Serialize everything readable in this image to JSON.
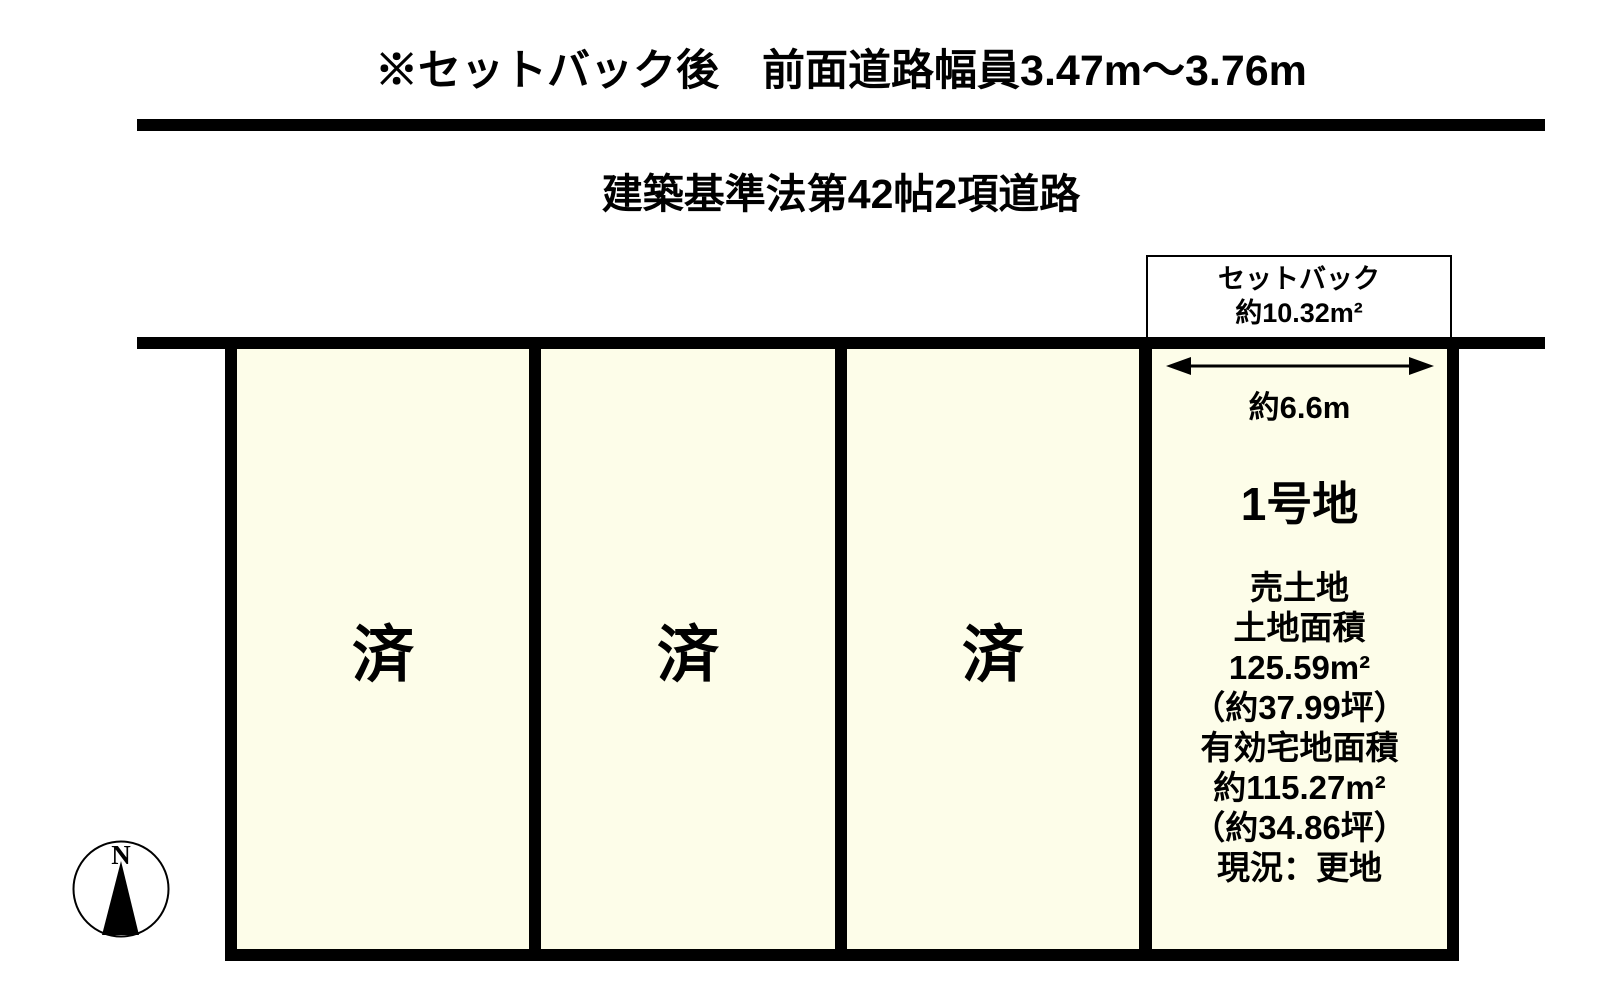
{
  "colors": {
    "plot_fill": "#FDFDE9",
    "line": "#000000",
    "background": "#FFFFFF"
  },
  "header": {
    "title": "※セットバック後　前面道路幅員3.47m～3.76m"
  },
  "road": {
    "label": "建築基準法第42帖2項道路"
  },
  "setback": {
    "label": "セットバック",
    "area": "約10.32m²"
  },
  "sold_plots": [
    {
      "label": "済"
    },
    {
      "label": "済"
    },
    {
      "label": "済"
    }
  ],
  "lot1": {
    "frontage": "約6.6m",
    "name": "1号地",
    "details": [
      "売土地",
      "土地面積",
      "125.59m²",
      "（約37.99坪）",
      "有効宅地面積",
      "約115.27m²",
      "（約34.86坪）",
      "現況：更地"
    ]
  },
  "compass": {
    "north": "N"
  }
}
